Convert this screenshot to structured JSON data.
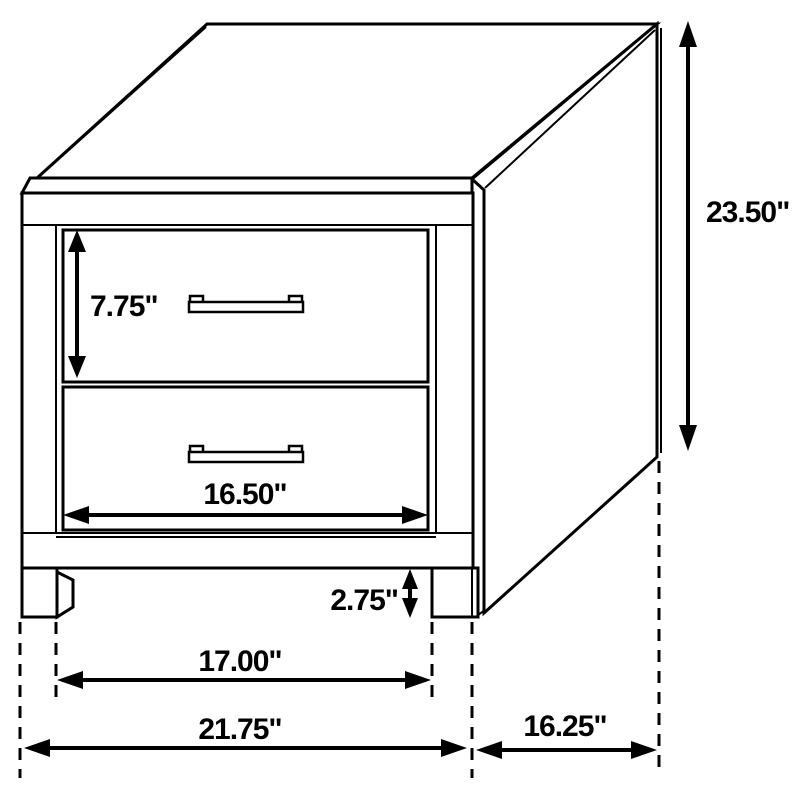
{
  "diagram": {
    "subject": "nightstand with two drawers",
    "colors": {
      "background": "#ffffff",
      "line": "#000000",
      "text": "#000000"
    }
  },
  "dimensions": {
    "drawer_height": "7.75\"",
    "overall_height": "23.50\"",
    "drawer_width": "16.50\"",
    "base_clearance": "2.75\"",
    "leg_inner_span": "17.00\"",
    "overall_width": "21.75\"",
    "side_depth": "16.25\""
  }
}
